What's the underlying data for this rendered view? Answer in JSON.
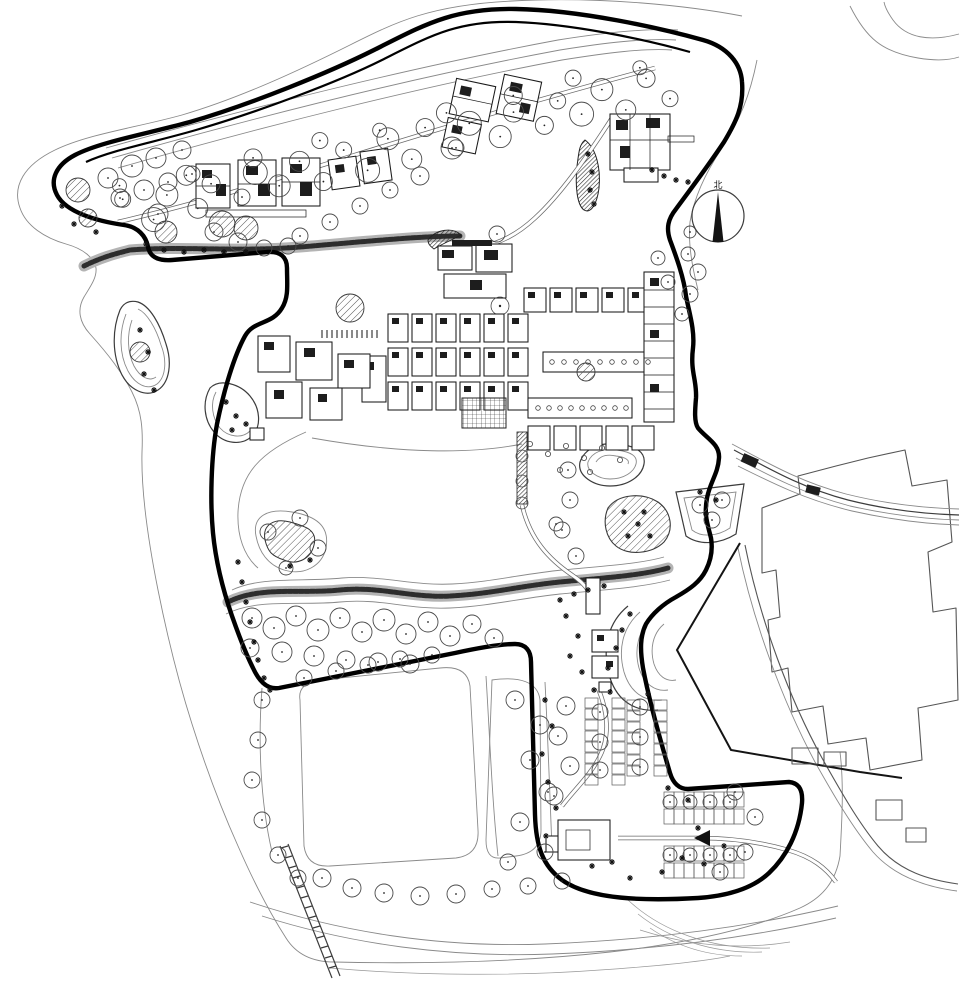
{
  "drawing": {
    "north_arrow_label": "北",
    "north_arrow_symbol": "north-needle-icon",
    "entry_arrow_symbol": "site-entry-arrow-icon"
  },
  "colors": {
    "paper": "#ffffff",
    "ink": "#161616",
    "boundary": "#000000",
    "mid_line": "#3c3c3c",
    "fine_line": "#8a8a8a",
    "veg_line": "#4a4a4a"
  }
}
